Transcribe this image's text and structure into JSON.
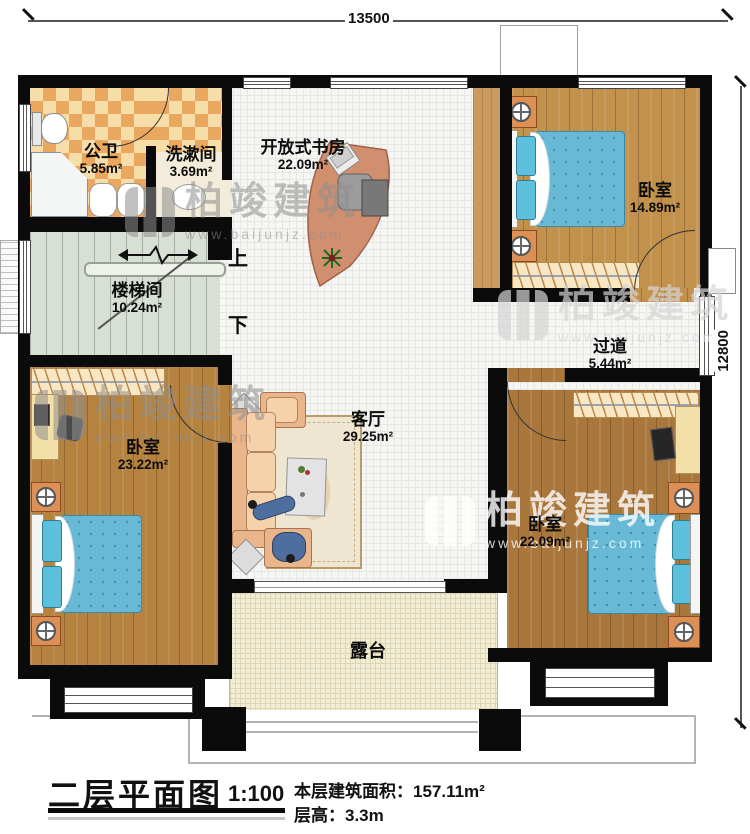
{
  "dimensions": {
    "top": "13500",
    "right": "12800"
  },
  "stairs": {
    "up": "上",
    "down": "下"
  },
  "rooms": {
    "public_bath": {
      "name": "公卫",
      "area": "5.85m²"
    },
    "washroom": {
      "name": "洗漱间",
      "area": "3.69m²"
    },
    "open_study": {
      "name": "开放式书房",
      "area": "22.09m²"
    },
    "bedroom_top_right": {
      "name": "卧室",
      "area": "14.89m²"
    },
    "stairwell": {
      "name": "楼梯间",
      "area": "10.24m²"
    },
    "corridor": {
      "name": "过道",
      "area": "5.44m²"
    },
    "bedroom_bottom_left": {
      "name": "卧室",
      "area": "23.22m²"
    },
    "living_room": {
      "name": "客厅",
      "area": "29.25m²"
    },
    "bedroom_bottom_right": {
      "name": "卧室",
      "area": "22.09m²"
    },
    "terrace": {
      "name": "露台"
    }
  },
  "title_block": {
    "title": "二层平面图",
    "scale": "1:100",
    "floor_area_label": "本层建筑面积：",
    "floor_area_value": "157.11m²",
    "floor_height_label": "层高：",
    "floor_height_value": "3.3m"
  },
  "watermark": {
    "brand": "柏竣建筑",
    "url": "www.baijunjz.com"
  }
}
